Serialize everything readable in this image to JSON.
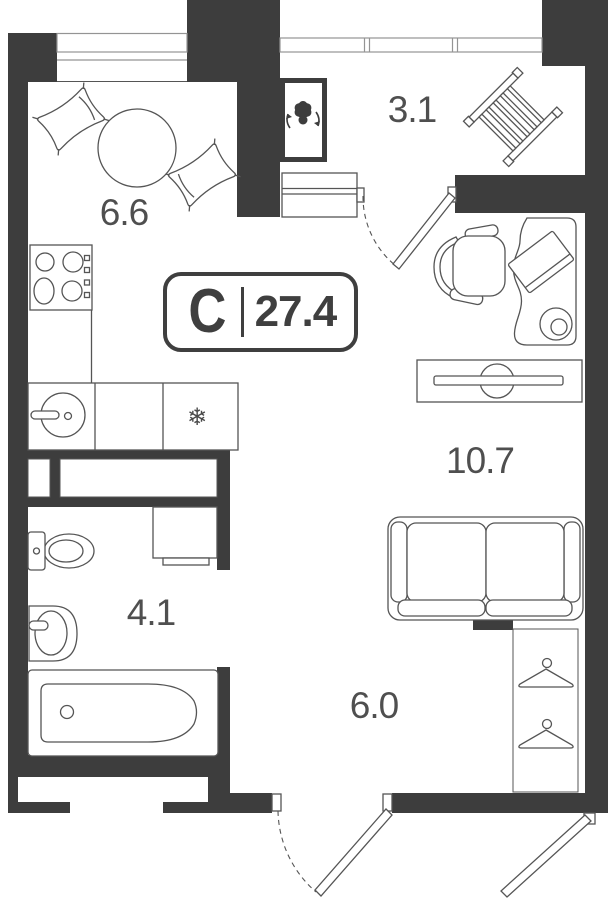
{
  "plan": {
    "badge": {
      "letter": "С",
      "area": "27.4"
    },
    "rooms": {
      "kitchen": {
        "label": "6.6"
      },
      "balcony": {
        "label": "3.1"
      },
      "living": {
        "label": "10.7"
      },
      "bathroom": {
        "label": "4.1"
      },
      "hall": {
        "label": "6.0"
      }
    },
    "icons": {
      "fridge_snowflake": "❄"
    },
    "colors": {
      "wall": "#3d3d3d",
      "furniture_line": "#555555",
      "window_line": "#949494",
      "label_text": "#4f4f4f",
      "background": "#ffffff"
    }
  }
}
